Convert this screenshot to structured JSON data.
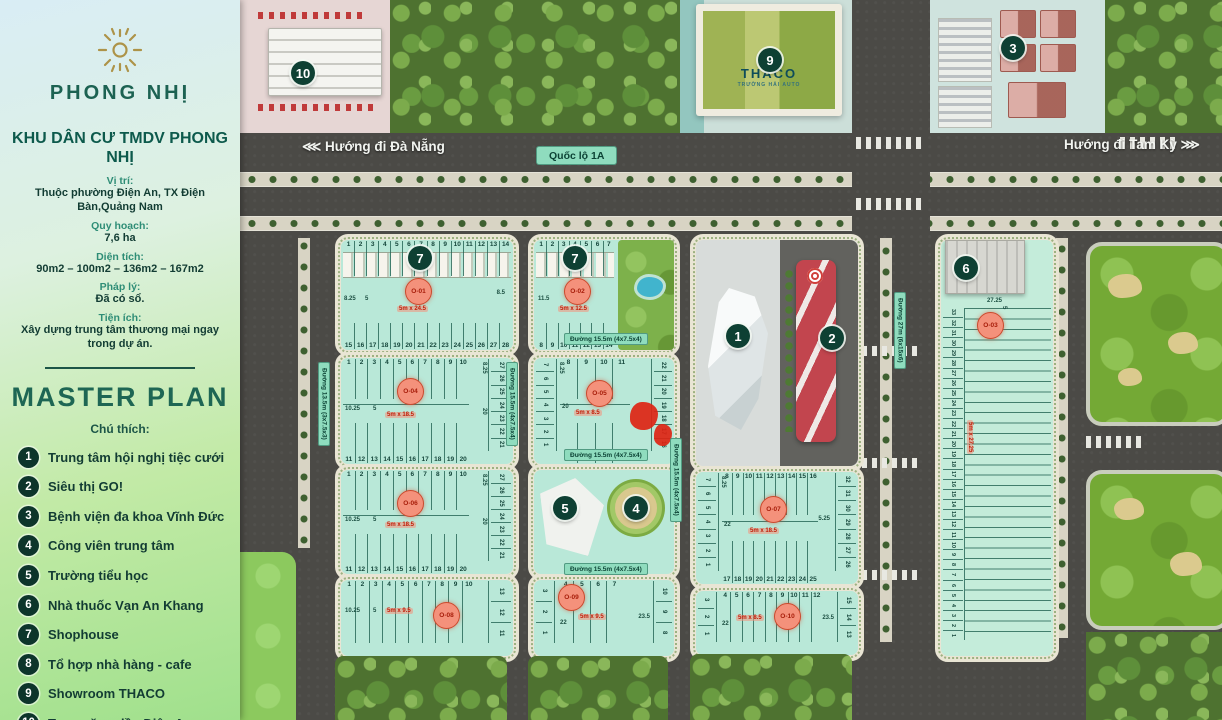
{
  "sidebar": {
    "brand": "PHONG NHỊ",
    "project_title": "KHU DÂN CƯ TMDV PHONG NHỊ",
    "info": [
      {
        "label": "Vị trí:",
        "value": "Thuộc phường Điện An, TX Điện Bàn,Quảng Nam"
      },
      {
        "label": "Quy hoạch:",
        "value": "7,6 ha"
      },
      {
        "label": "Diện tích:",
        "value": "90m2 – 100m2 – 136m2 – 167m2"
      },
      {
        "label": "Pháp lý:",
        "value": "Đã có sổ."
      },
      {
        "label": "Tiện ích:",
        "value": "Xây dựng trung tâm thương mại ngay trong dự án."
      }
    ],
    "master_plan_title": "MASTER PLAN",
    "legend_caption": "Chú thích:",
    "legend": [
      {
        "num": "1",
        "label": "Trung tâm hội nghị tiệc cưới"
      },
      {
        "num": "2",
        "label": "Siêu thị GO!"
      },
      {
        "num": "3",
        "label": "Bệnh viện đa khoa Vĩnh Đức"
      },
      {
        "num": "4",
        "label": "Công viên trung tâm"
      },
      {
        "num": "5",
        "label": "Trường tiểu học"
      },
      {
        "num": "6",
        "label": "Nhà thuốc Vạn An Khang"
      },
      {
        "num": "7",
        "label": "Shophouse"
      },
      {
        "num": "8",
        "label": "Tổ hợp nhà hàng - cafe"
      },
      {
        "num": "9",
        "label": "Showroom THACO"
      },
      {
        "num": "10",
        "label": "Trạm xăng dầu Điện An"
      }
    ]
  },
  "map": {
    "roads": {
      "da_nang": "Hướng đi Đà Nẵng",
      "da_nang_arrows": "⋘",
      "tam_ky": "Hướng đi Tam Kỳ",
      "tam_ky_arrows": "⋙",
      "highway": "Quốc lộ 1A",
      "r155": "Đường 15.5m (4x7.5x4)",
      "r135": "Đường 13.5m (3x7.5x3)",
      "r27": "Đường 27m (6x15x6)"
    },
    "thaco": {
      "name": "THACO",
      "sub": "TRƯỜNG HẢI AUTO"
    },
    "markers": {
      "event": "1",
      "go": "2",
      "hospital": "3",
      "park": "4",
      "school": "5",
      "pharmacy": "6",
      "shophouse_a": "7",
      "shophouse_b": "7",
      "thaco": "9",
      "gas": "10"
    },
    "blocks": {
      "o01": {
        "code": "O-01",
        "size": "5m x 24.5",
        "top": [
          "1",
          "2",
          "3",
          "4",
          "5",
          "6",
          "7",
          "8",
          "9",
          "10",
          "11",
          "12",
          "13",
          "14"
        ],
        "bottom": [
          "15",
          "16",
          "17",
          "18",
          "19",
          "20",
          "21",
          "22",
          "23",
          "24",
          "25",
          "26",
          "27",
          "28"
        ],
        "d1": "8.25",
        "d2": "5",
        "d3": "8.5"
      },
      "o02": {
        "code": "O-02",
        "size": "5m x 12.5",
        "top": [
          "1",
          "2",
          "3",
          "4",
          "5",
          "6",
          "7"
        ],
        "bottom": [
          "8",
          "9",
          "10",
          "11",
          "12",
          "13",
          "14"
        ],
        "d1": "11.5"
      },
      "o03": {
        "code": "O-03",
        "size": "5m x 27.25",
        "plots": [
          "33",
          "32",
          "31",
          "30",
          "29",
          "28",
          "27",
          "26",
          "25",
          "24",
          "23",
          "22",
          "21",
          "20",
          "19",
          "18",
          "17",
          "16",
          "15",
          "14",
          "13",
          "12",
          "11",
          "10",
          "9",
          "8",
          "7",
          "6",
          "5",
          "4",
          "3",
          "2",
          "1"
        ],
        "d1": "27.25",
        "d2": "5"
      },
      "o04": {
        "code": "O-04",
        "size": "5m x 18.5",
        "top": [
          "1",
          "2",
          "3",
          "4",
          "5",
          "6",
          "7",
          "8",
          "9",
          "10"
        ],
        "bottom": [
          "11",
          "12",
          "13",
          "14",
          "15",
          "16",
          "17",
          "18",
          "19",
          "20"
        ],
        "right": [
          "27",
          "26",
          "25",
          "24",
          "23",
          "22",
          "21"
        ],
        "d1": "10.25",
        "d2": "5",
        "d3": "8.25",
        "d4": "20"
      },
      "o05": {
        "code": "O-05",
        "size": "5m x 8.5",
        "left": [
          "7",
          "6",
          "5",
          "4",
          "3",
          "2",
          "1"
        ],
        "top": [
          "8",
          "9",
          "10",
          "11"
        ],
        "bottom": [
          "12",
          "13",
          "14",
          "15"
        ],
        "right": [
          "22",
          "21",
          "20",
          "19",
          "18",
          "17",
          "16"
        ],
        "d1": "20",
        "d2": "8.25"
      },
      "o06": {
        "code": "O-06",
        "size": "5m x 18.5",
        "top": [
          "1",
          "2",
          "3",
          "4",
          "5",
          "6",
          "7",
          "8",
          "9",
          "10"
        ],
        "bottom": [
          "11",
          "12",
          "13",
          "14",
          "15",
          "16",
          "17",
          "18",
          "19",
          "20"
        ],
        "right": [
          "27",
          "26",
          "25",
          "24",
          "23",
          "22",
          "21"
        ],
        "d1": "10.25",
        "d2": "5",
        "d3": "8.25",
        "d4": "20"
      },
      "o07": {
        "code": "O-07",
        "size": "5m x 18.5",
        "left": [
          "7",
          "6",
          "5",
          "4",
          "3",
          "2",
          "1"
        ],
        "top": [
          "8",
          "9",
          "10",
          "11",
          "12",
          "13",
          "14",
          "15",
          "16"
        ],
        "bottom": [
          "17",
          "18",
          "19",
          "20",
          "21",
          "22",
          "23",
          "24",
          "25"
        ],
        "right": [
          "32",
          "31",
          "30",
          "29",
          "28",
          "27",
          "26"
        ],
        "d1": "22",
        "d2": "5.25",
        "d3": "8.25"
      },
      "o08": {
        "code": "O-08",
        "size": "5m x 9.5",
        "top": [
          "1",
          "2",
          "3",
          "4",
          "5",
          "6",
          "7",
          "8",
          "9",
          "10"
        ],
        "right": [
          "13",
          "12",
          "11"
        ],
        "d1": "10.25",
        "d2": "5"
      },
      "o09": {
        "code": "O-09",
        "size": "5m x 9.5",
        "left": [
          "3",
          "2",
          "1"
        ],
        "top": [
          "4",
          "5",
          "6",
          "7"
        ],
        "right": [
          "10",
          "9",
          "8"
        ],
        "d1": "22",
        "d2": "23.5"
      },
      "o10": {
        "code": "O-10",
        "size": "5m x 8.5",
        "left": [
          "3",
          "2",
          "1"
        ],
        "top": [
          "4",
          "5",
          "6",
          "7",
          "8",
          "9",
          "10",
          "11",
          "12"
        ],
        "right": [
          "15",
          "14",
          "13"
        ],
        "d1": "22",
        "d2": "23.5"
      }
    }
  }
}
